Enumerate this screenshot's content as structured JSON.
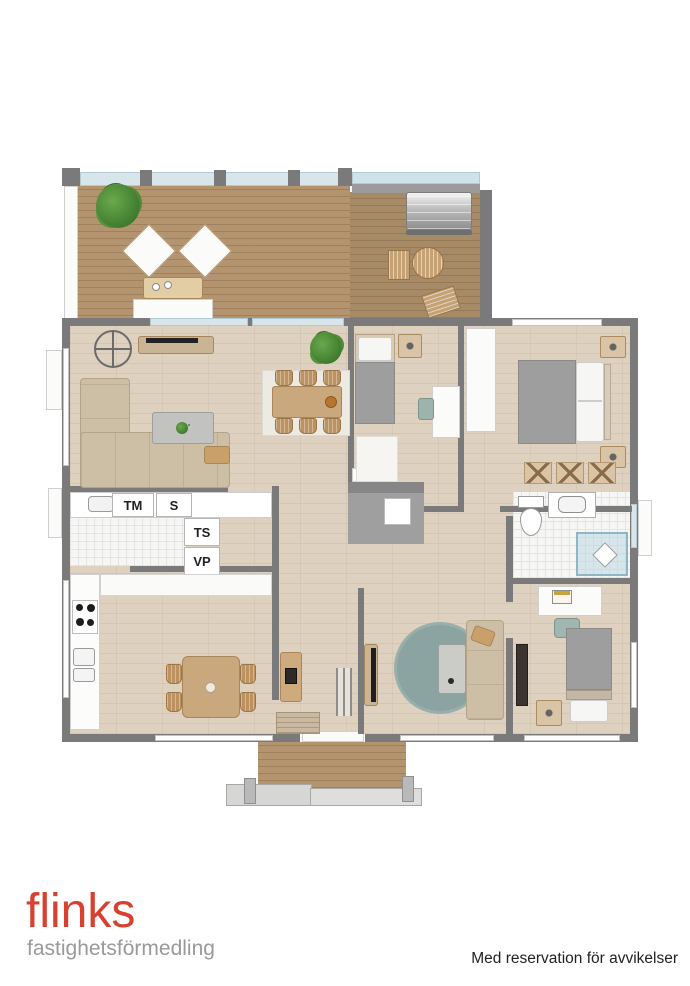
{
  "floorplan": {
    "labels": {
      "tm": "TM",
      "s": "S",
      "ts": "TS",
      "vp": "VP"
    }
  },
  "footer": {
    "logo_title": "flinks",
    "logo_subtitle": "fastighetsförmedling",
    "disclaimer": "Med reservation för avvikelser"
  },
  "colors": {
    "wall": "#7a7a7a",
    "deck_wood": "#b3946f",
    "deck_wood_dark": "#a78a66",
    "interior_wood": "#ded1c0",
    "glass": "#d8e6ec",
    "sofa": "#ccbfa6",
    "bed_gray": "#9e9e9e",
    "rug_teal": "#8ba4a1",
    "wood_furniture": "#cfaa7c",
    "plant": "#3f7a2e",
    "logo_red": "#d8412f",
    "logo_gray": "#9a9a9a",
    "disclaimer_text": "#222222"
  }
}
